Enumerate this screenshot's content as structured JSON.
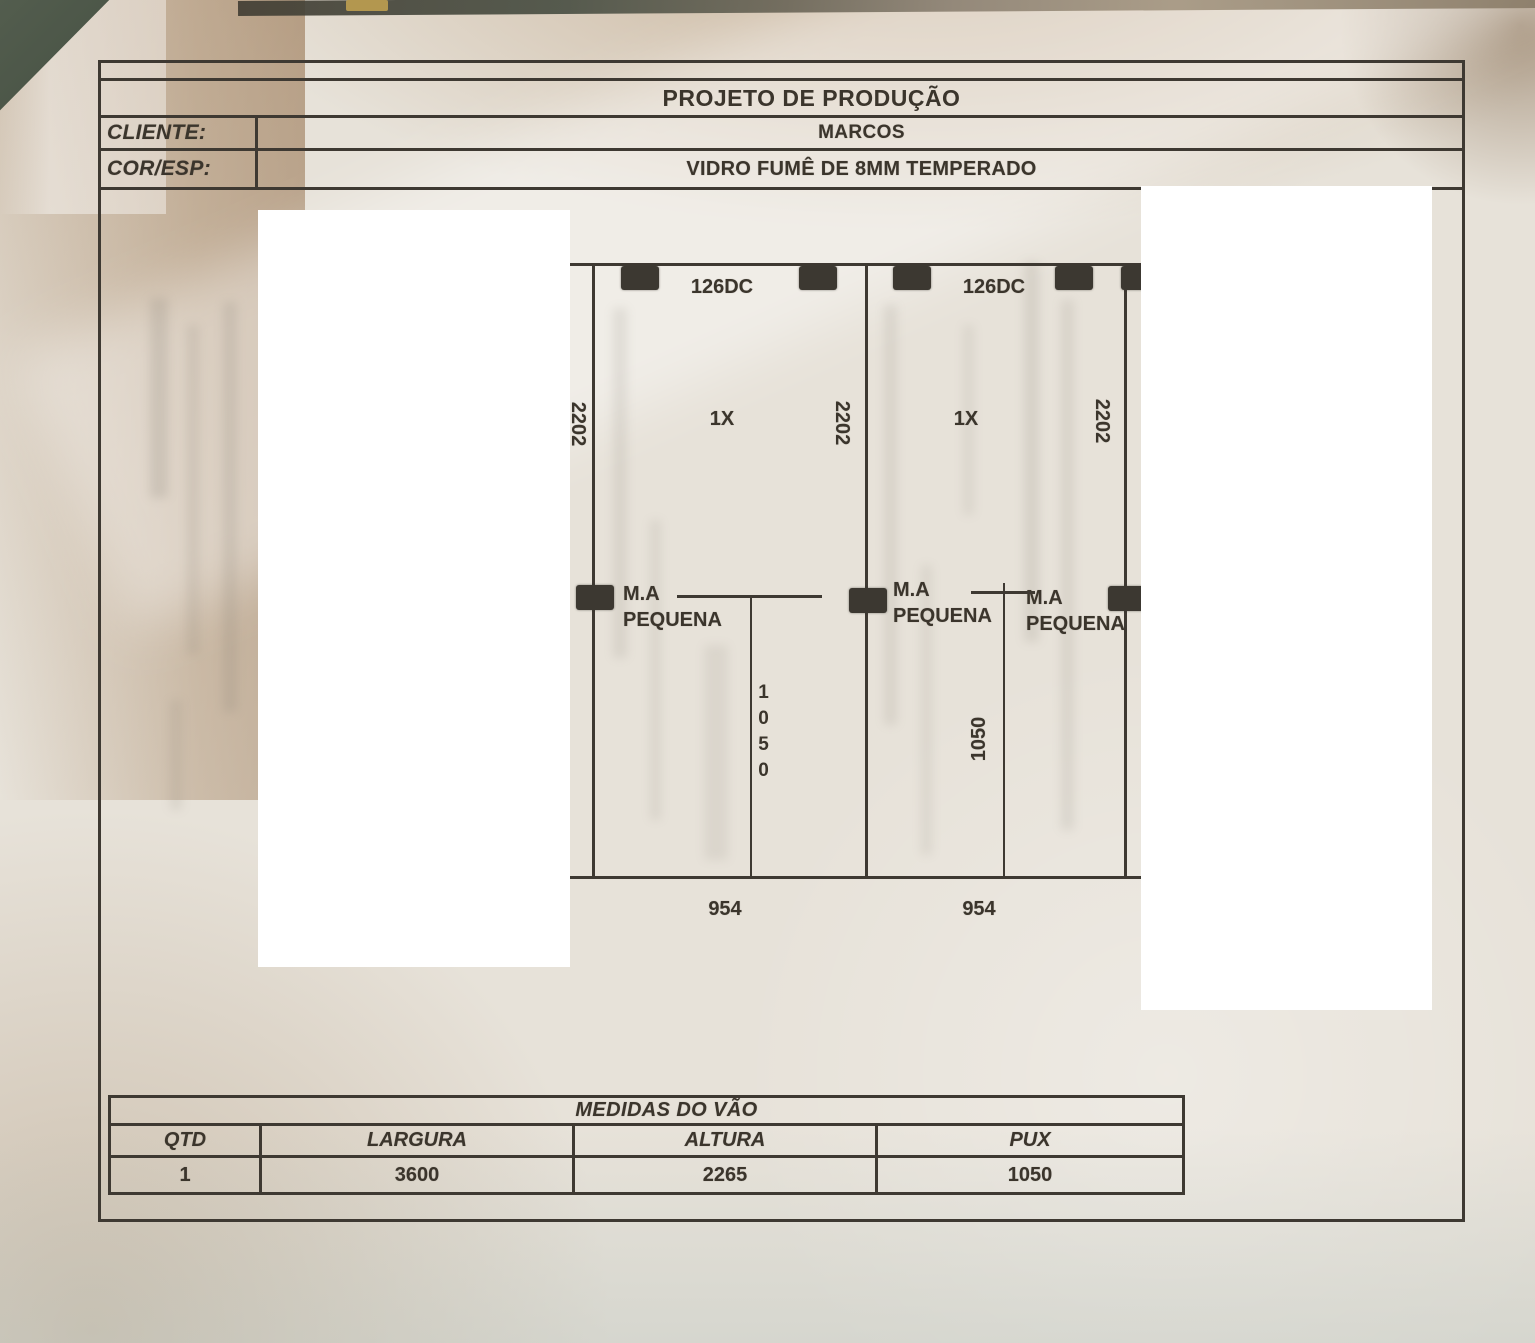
{
  "document": {
    "title": "PROJETO DE PRODUÇÃO",
    "fields": [
      {
        "label": "CLIENTE:",
        "value": "MARCOS"
      },
      {
        "label": "COR/ESP:",
        "value": "VIDRO FUMÊ DE 8MM TEMPERADO"
      }
    ]
  },
  "drawing": {
    "left_edge_height": "2202",
    "panels": [
      {
        "hinge_code": "126DC",
        "quantity": "1X",
        "height": "2202",
        "width": "954"
      },
      {
        "hinge_code": "126DC",
        "quantity": "1X",
        "height": "2202",
        "width": "954"
      }
    ],
    "handles": [
      {
        "line1": "M.A",
        "line2": "PEQUENA"
      },
      {
        "line1": "M.A",
        "line2": "PEQUENA"
      },
      {
        "line1": "M.A",
        "line2": "PEQUENA"
      }
    ],
    "pull_heights": [
      "1050",
      "1050"
    ]
  },
  "measures": {
    "title": "MEDIDAS DO VÃO",
    "columns": [
      "QTD",
      "LARGURA",
      "ALTURA",
      "PUX"
    ],
    "values": [
      "1",
      "3600",
      "2265",
      "1050"
    ]
  },
  "colors": {
    "ink": "#3b352c",
    "line": "#3e3932",
    "clamp": "#3c3831",
    "paper": "#e7e2d9",
    "background_green": "#4a5446",
    "background_tan": "#b99a78"
  }
}
